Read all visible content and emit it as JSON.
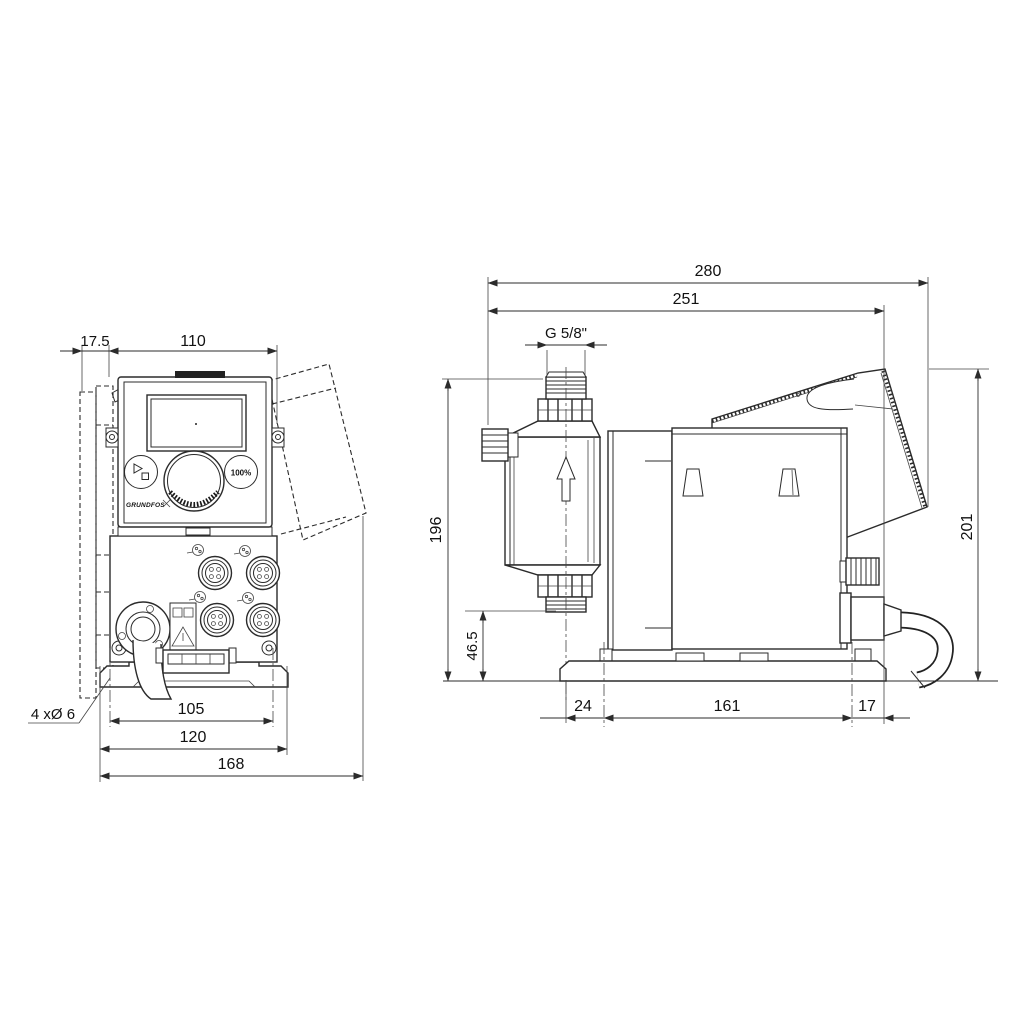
{
  "front_view": {
    "dims": {
      "bracket_offset": "17.5",
      "housing_width": "110",
      "hole_spacing": "105",
      "plate_width": "120",
      "overall_width": "168",
      "mounting_holes": "4 xØ 6"
    },
    "panel": {
      "max_button": "100%",
      "logo": "GRUNDFOS"
    }
  },
  "side_view": {
    "dims": {
      "overall_depth": "280",
      "depth_to_panel": "251",
      "connection_thread": "G 5/8\"",
      "height_to_connection": "196",
      "inlet_height": "46.5",
      "front_offset": "24",
      "base_length": "161",
      "rear_offset": "17",
      "overall_height": "201"
    }
  }
}
